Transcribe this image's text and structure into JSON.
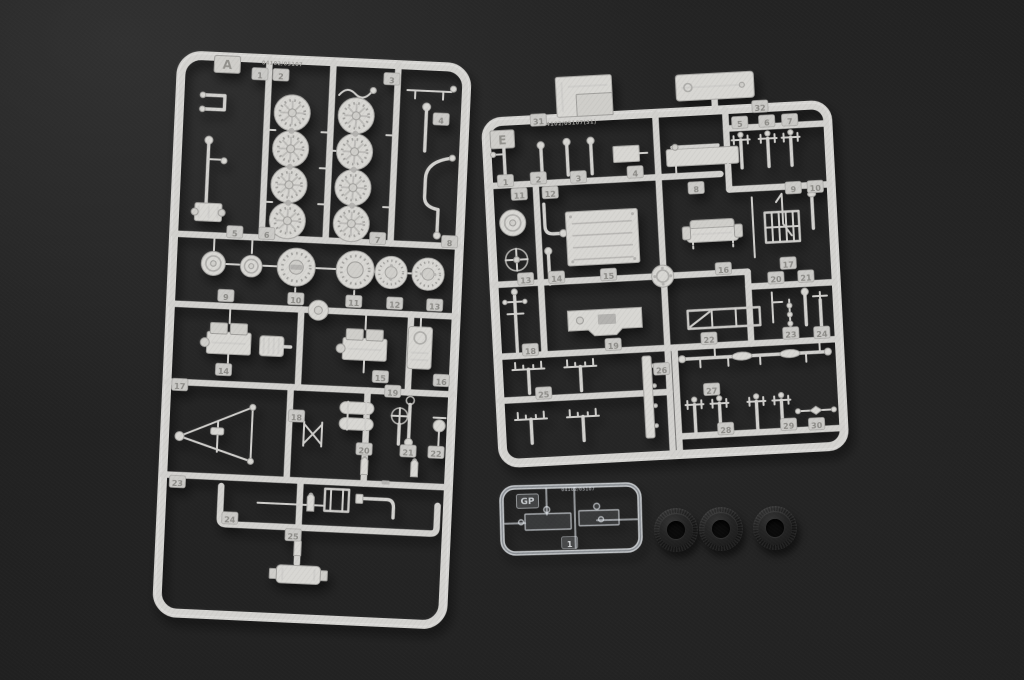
{
  "photo": {
    "subject": "plastic model kit sprues and rubber tires on dark backdrop",
    "background_color": "#232323",
    "plastic_color": "#d6d5d2",
    "tire_color": "#1a1a1a"
  },
  "sprue_a": {
    "letter": "A",
    "mold_text": "04102/05107",
    "part_tags": [
      "1",
      "2",
      "3",
      "4",
      "5",
      "6",
      "7",
      "8",
      "9",
      "10",
      "11",
      "12",
      "13",
      "14",
      "15",
      "16",
      "17",
      "18",
      "19",
      "20",
      "21",
      "22",
      "23",
      "24",
      "25"
    ]
  },
  "sprue_e": {
    "letter": "E",
    "mold_text": "04102/05107(31)",
    "part_tags": [
      "1",
      "2",
      "3",
      "4",
      "5",
      "6",
      "7",
      "8",
      "9",
      "10",
      "11",
      "12",
      "13",
      "14",
      "15",
      "16",
      "17",
      "18",
      "19",
      "20",
      "21",
      "22",
      "23",
      "24",
      "25",
      "26",
      "27",
      "28",
      "29",
      "30",
      "31",
      "32"
    ]
  },
  "sprue_gp": {
    "letter": "GP",
    "mold_text": "04102/05107",
    "part_tags": [
      "1"
    ]
  },
  "tires": {
    "count": 3
  }
}
